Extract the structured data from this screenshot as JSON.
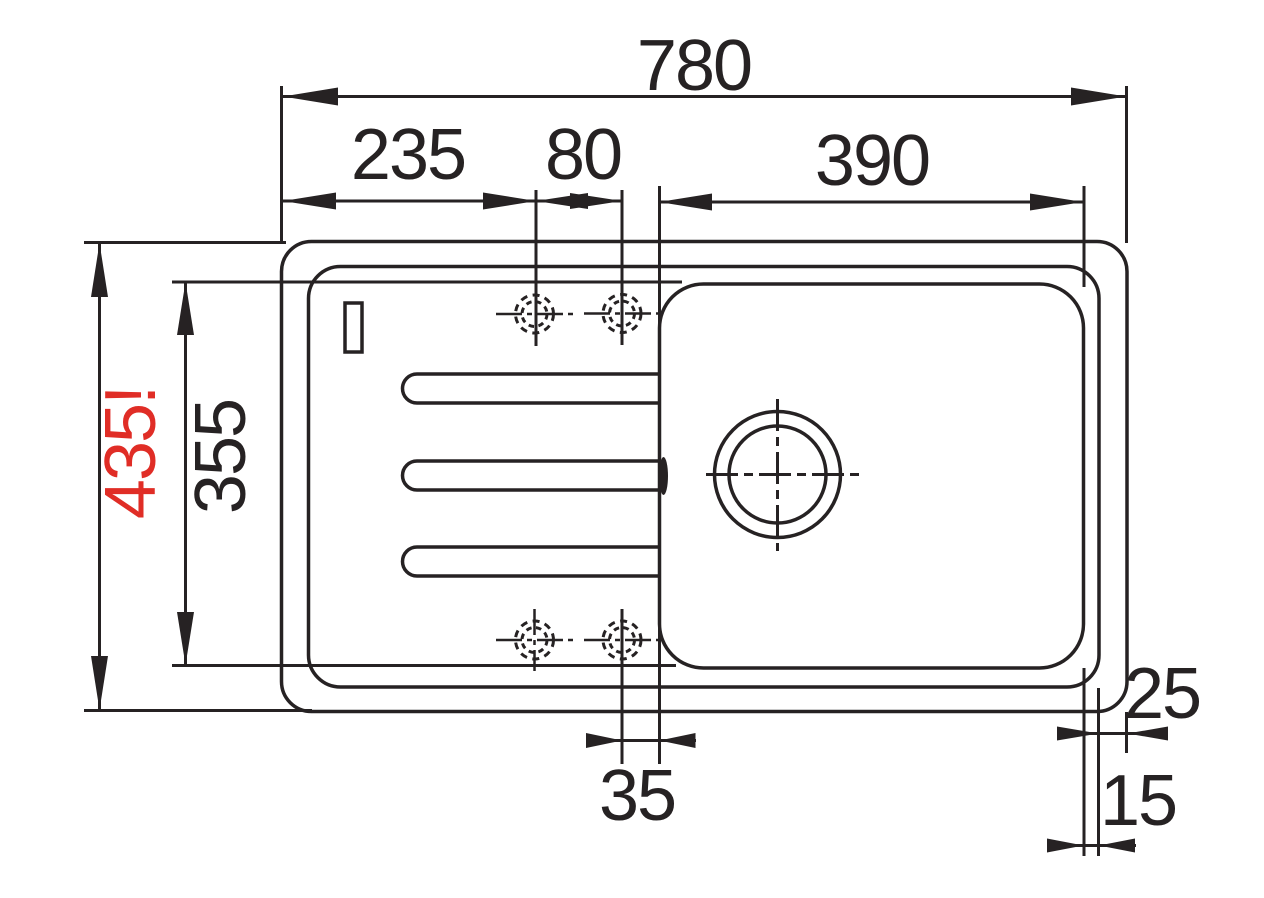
{
  "drawing": {
    "kind": "sink-top-view-dimension-drawing",
    "subject": "Inset kitchen sink with drainer, bowl, drain hole and four tap holes",
    "colors": {
      "line": "#262223",
      "background": "#ffffff",
      "warning_red": "#e02d26"
    },
    "dimensions": {
      "overall_width": "780",
      "left_edge_to_hole": "235",
      "hole_spacing": "80",
      "bowl_width": "390",
      "overall_depth": "435!",
      "bowl_depth": "355",
      "hole_to_bowl_edge": "35",
      "right_rim_width": "25",
      "rim_to_bowl_gap": "15"
    }
  }
}
